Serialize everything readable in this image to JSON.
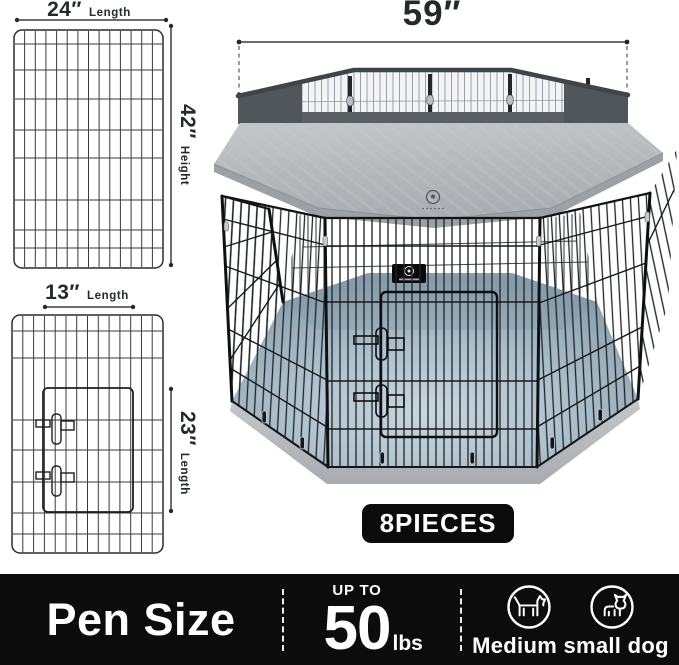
{
  "diagram": {
    "large_panel": {
      "width_value": "24″",
      "width_unit_label": "Length",
      "height_value": "42″",
      "height_unit_label": "Height"
    },
    "door_panel": {
      "width_value": "13″",
      "width_unit_label": "Length",
      "height_value": "23″",
      "height_unit_label": "Length"
    },
    "pen_width_value": "59″",
    "pieces_badge": "8PIECES"
  },
  "footer": {
    "title": "Pen Size",
    "weight": {
      "prefix": "UP TO",
      "value": "50",
      "unit": "lbs"
    },
    "dog_size_label": "Medium small dog",
    "icons": [
      "medium-dog-icon",
      "small-dog-icon"
    ]
  },
  "colors": {
    "footer_background": "#0c0c0c",
    "badge_background": "#0b0b0b",
    "cover_gray": "#b6babd",
    "mesh_dark": "#53585c",
    "floor_blue_gray": "#a9bdc9",
    "wire_black": "#1c1c1c",
    "text_dark": "#26292c"
  }
}
